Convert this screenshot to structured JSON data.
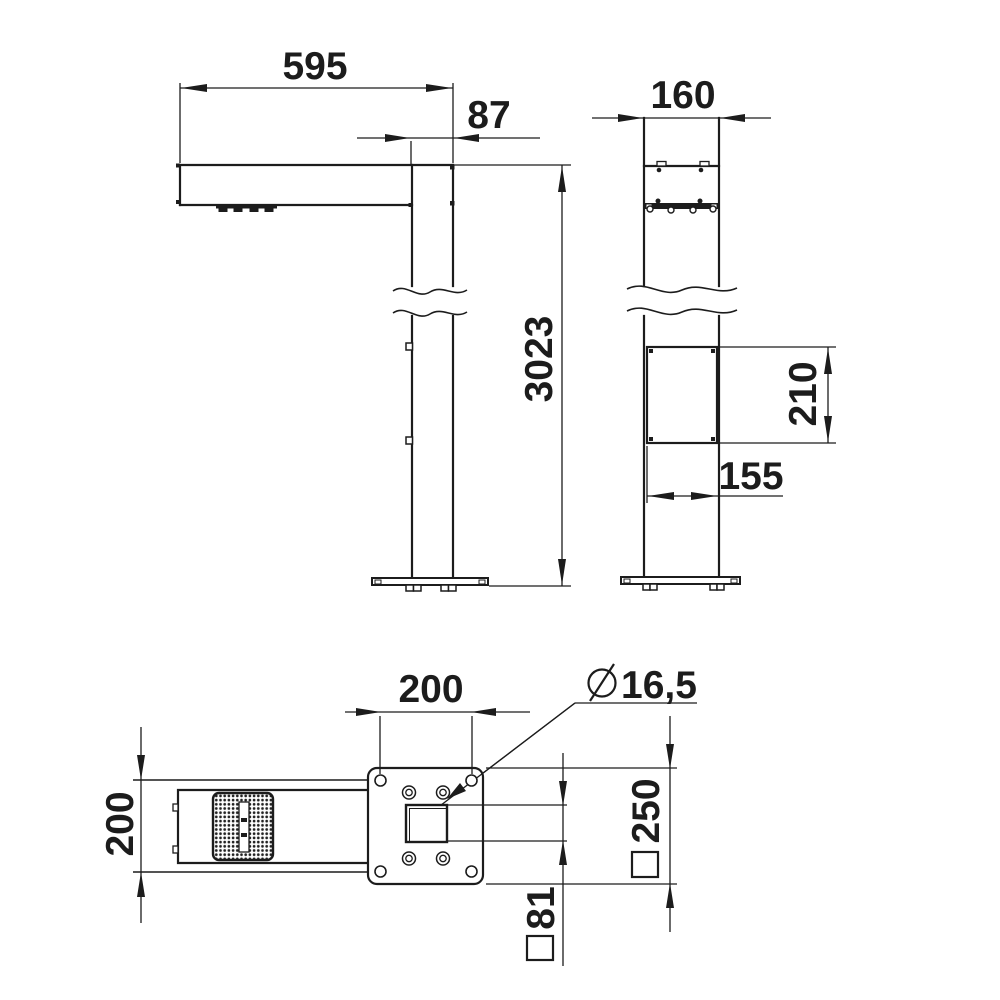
{
  "page": {
    "background": "#ffffff",
    "line_color": "#1c1c1c"
  },
  "drawing": {
    "type": "technical-dimension-drawing",
    "views": {
      "front": {
        "name": "front-elevation",
        "dims": {
          "arm_length": "595",
          "pole_width": "87",
          "total_height": "3023"
        }
      },
      "side": {
        "name": "side-elevation",
        "dims": {
          "pole_depth": "160",
          "door_height": "210",
          "door_width": "155"
        }
      },
      "plan": {
        "name": "base-plan",
        "dims": {
          "arm_width": "200",
          "hole_spacing": "200",
          "hole_diameter": "16,5",
          "base_plate_square": "250",
          "pole_square": "81"
        }
      }
    }
  }
}
